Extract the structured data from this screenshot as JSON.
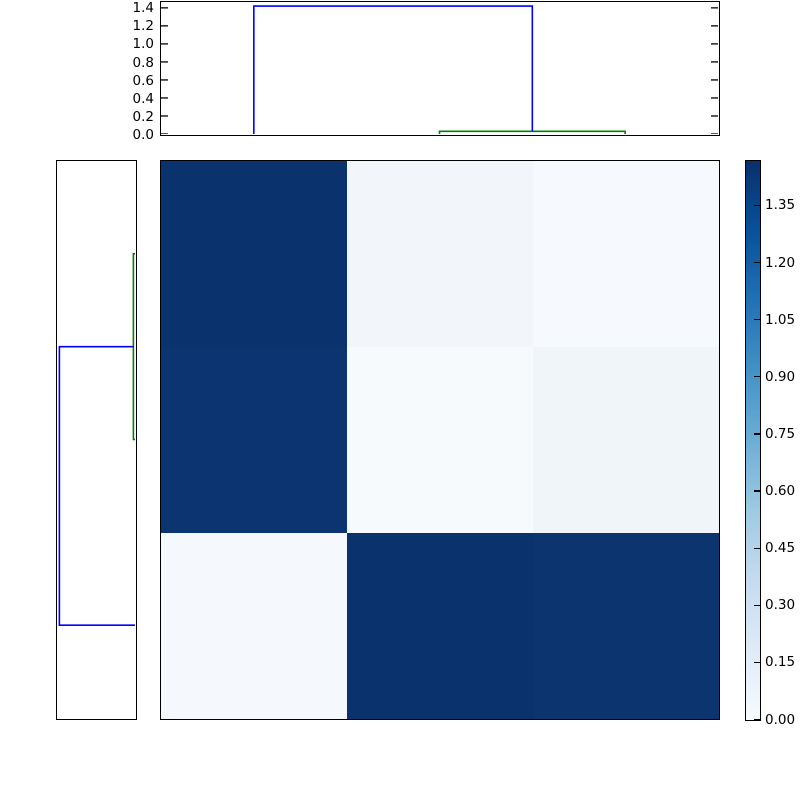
{
  "figure": {
    "background": "#ffffff",
    "frame_color": "#000000"
  },
  "chart_data": [
    {
      "type": "dendrogram",
      "panel": "top",
      "orientation": "top",
      "leaf_count": 3,
      "value_lim": [
        0,
        1.465
      ],
      "axis_ticks": [
        {
          "value": 0.0,
          "label": "0.0"
        },
        {
          "value": 0.2,
          "label": "0.2"
        },
        {
          "value": 0.4,
          "label": "0.4"
        },
        {
          "value": 0.6,
          "label": "0.6"
        },
        {
          "value": 0.8,
          "label": "0.8"
        },
        {
          "value": 1.0,
          "label": "1.0"
        },
        {
          "value": 1.2,
          "label": "1.2"
        },
        {
          "value": 1.4,
          "label": "1.4"
        }
      ],
      "links": [
        {
          "p1": 1.5,
          "p2": 2.5,
          "height": 0.03,
          "drop1": 0.0,
          "drop2": 0.0,
          "color": "#008000",
          "name": "green-link"
        },
        {
          "p1": 0.5,
          "p2": 2.0,
          "height": 1.42,
          "drop1": 0.0,
          "drop2": 0.03,
          "color": "#0000ff",
          "name": "blue-link"
        }
      ]
    },
    {
      "type": "dendrogram",
      "panel": "left",
      "orientation": "left",
      "leaf_count": 3,
      "value_lim": [
        0,
        1.465
      ],
      "axis_ticks": [],
      "links": [
        {
          "p1": 0.5,
          "p2": 1.5,
          "height": 0.03,
          "drop1": 0.0,
          "drop2": 0.0,
          "color": "#008000",
          "name": "green-link"
        },
        {
          "p1": 1.0,
          "p2": 2.5,
          "height": 1.42,
          "drop1": 0.03,
          "drop2": 0.0,
          "color": "#0000ff",
          "name": "blue-link"
        }
      ]
    },
    {
      "type": "heatmap",
      "rows": 3,
      "cols": 3,
      "colormap": "Blues",
      "vmin": 0.0,
      "vmax": 1.465,
      "values": [
        [
          1.42,
          0.1,
          0.06
        ],
        [
          1.4,
          0.05,
          0.12
        ],
        [
          0.06,
          1.4,
          1.38
        ]
      ],
      "cell_colors": [
        [
          "#0a326d",
          "#f2f6fa",
          "#f6f9fd"
        ],
        [
          "#0b3470",
          "#f7fafd",
          "#f0f5f9"
        ],
        [
          "#f5f9fd",
          "#0a336e",
          "#0c356f"
        ]
      ]
    },
    {
      "type": "colorbar",
      "value_lim": [
        0,
        1.465
      ],
      "ticks": [
        {
          "value": 0.0,
          "label": "0.00"
        },
        {
          "value": 0.15,
          "label": "0.15"
        },
        {
          "value": 0.3,
          "label": "0.30"
        },
        {
          "value": 0.45,
          "label": "0.45"
        },
        {
          "value": 0.6,
          "label": "0.60"
        },
        {
          "value": 0.75,
          "label": "0.75"
        },
        {
          "value": 0.9,
          "label": "0.90"
        },
        {
          "value": 1.05,
          "label": "1.05"
        },
        {
          "value": 1.2,
          "label": "1.20"
        },
        {
          "value": 1.35,
          "label": "1.35"
        }
      ],
      "gradient_stops": [
        {
          "at": 0.0,
          "color": "#f7fbff"
        },
        {
          "at": 0.125,
          "color": "#deebf7"
        },
        {
          "at": 0.25,
          "color": "#c6dbef"
        },
        {
          "at": 0.375,
          "color": "#9ecae1"
        },
        {
          "at": 0.5,
          "color": "#6baed6"
        },
        {
          "at": 0.625,
          "color": "#4292c6"
        },
        {
          "at": 0.75,
          "color": "#2171b5"
        },
        {
          "at": 0.875,
          "color": "#08519c"
        },
        {
          "at": 1.0,
          "color": "#08306b"
        }
      ]
    }
  ]
}
